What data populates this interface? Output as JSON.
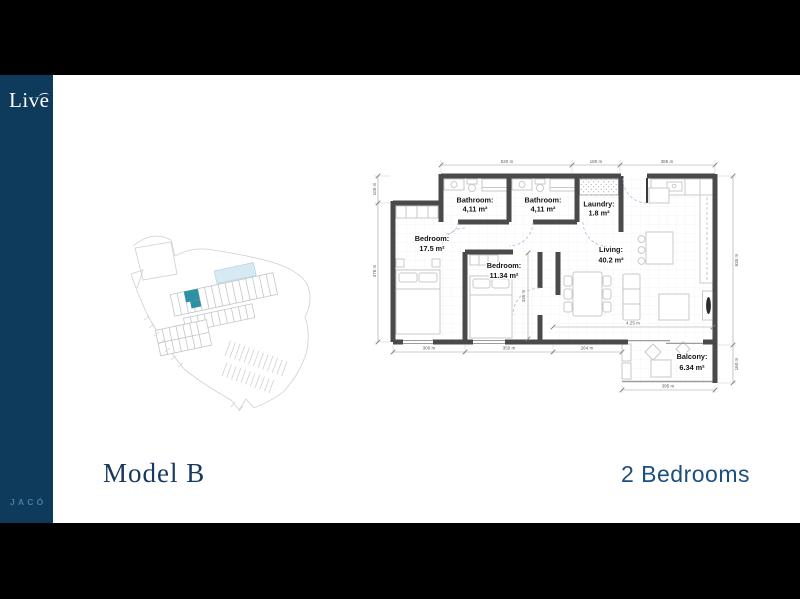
{
  "slide": {
    "brand": {
      "logo": "Live",
      "location": "JACÓ"
    },
    "footer": {
      "model_title": "Model B",
      "unit_type": "2 Bedrooms"
    }
  },
  "floor_plan": {
    "rooms": {
      "bathroom1": {
        "name": "Bathroom:",
        "area": "4,11 m²"
      },
      "bathroom2": {
        "name": "Bathroom:",
        "area": "4,11 m²"
      },
      "laundry": {
        "name": "Laundry:",
        "area": "1.8 m²"
      },
      "bedroom1": {
        "name": "Bedroom:",
        "area": "17.5 m²"
      },
      "bedroom2": {
        "name": "Bedroom:",
        "area": "11.34 m²"
      },
      "living": {
        "name": "Living:",
        "area": "40.2 m²"
      },
      "balcony": {
        "name": "Balcony:",
        "area": "6.34 m²"
      }
    },
    "dimensions": {
      "top": {
        "d1": "530 m",
        "d2": "180 m",
        "d3": "385 m"
      },
      "left": {
        "d1": "105 m",
        "d2": "478 m"
      },
      "right": {
        "d1": "635 m",
        "d2": "160 m"
      },
      "bottom": {
        "d1": "300 m",
        "d2": "350 m",
        "d3": "264 m"
      },
      "balcony_bottom": "395 m",
      "interior": {
        "vertical": "335 m",
        "horizontal": "4.25 m"
      }
    }
  },
  "colors": {
    "sidebar_navy": "#0e3a5b",
    "accent_teal": "#2e8fa5",
    "title_navy": "#17395e",
    "subtitle_blue": "#1d4e80",
    "wall_gray": "#4a4a4c",
    "pool_blue": "#d7eaf4"
  }
}
